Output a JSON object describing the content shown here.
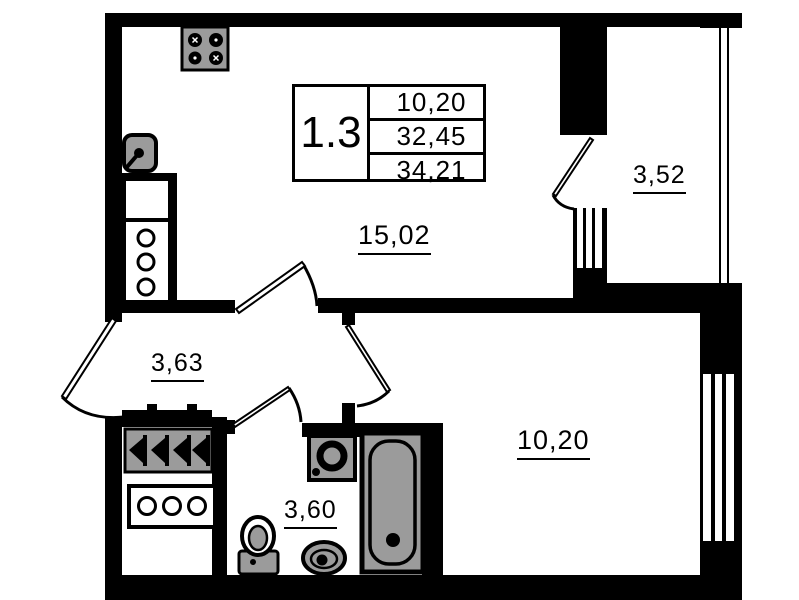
{
  "document_type": "apartment-floor-plan",
  "unit_card": {
    "unit_type": "1.3",
    "values": [
      "10,20",
      "32,45",
      "34,21"
    ]
  },
  "rooms": [
    {
      "name": "living-kitchen",
      "area": "15,02"
    },
    {
      "name": "balcony",
      "area": "3,52"
    },
    {
      "name": "hallway",
      "area": "3,63"
    },
    {
      "name": "bathroom",
      "area": "3,60"
    },
    {
      "name": "bedroom",
      "area": "10,20"
    }
  ],
  "fixtures": [
    "stove",
    "kitchen-sink",
    "kitchen-counter",
    "wardrobe-hangers",
    "appliance-counter",
    "washing-machine",
    "toilet",
    "bathroom-sink",
    "bathtub"
  ],
  "colors": {
    "wall": "#000000",
    "background": "#ffffff",
    "fixture_fill": "#9b9b9b"
  }
}
